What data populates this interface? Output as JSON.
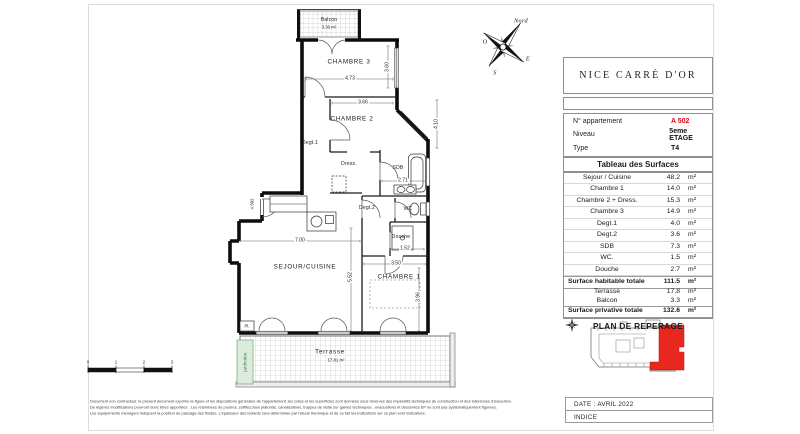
{
  "project": {
    "title": "NICE CARRÉ D'OR"
  },
  "apartment": {
    "rows": [
      {
        "label": "N° appartement",
        "value": "A 502"
      },
      {
        "label": "Niveau",
        "value": "5eme ETAGE"
      },
      {
        "label": "Type",
        "value": "T4"
      }
    ]
  },
  "surfaces": {
    "title": "Tableau des Surfaces",
    "unit": "m²",
    "rows": [
      {
        "label": "Sejour / Cuisine",
        "value": "48.2"
      },
      {
        "label": "Chambre 1",
        "value": "14.0"
      },
      {
        "label": "Chambre 2 + Dress.",
        "value": "15.3"
      },
      {
        "label": "Chambre 3",
        "value": "14.9"
      },
      {
        "label": "Degt.1",
        "value": "4.0"
      },
      {
        "label": "Degt.2",
        "value": "3.6"
      },
      {
        "label": "SDB",
        "value": "7.3"
      },
      {
        "label": "WC.",
        "value": "1.5"
      },
      {
        "label": "Douche",
        "value": "2.7"
      }
    ],
    "habitable": {
      "label": "Surface habitable totale",
      "value": "111.5"
    },
    "annexes": [
      {
        "label": "Terrasse",
        "value": "17.8"
      },
      {
        "label": "Balcon",
        "value": "3.3"
      }
    ],
    "privative": {
      "label": "Surface privative totale",
      "value": "132.6"
    }
  },
  "reperage": {
    "title": "PLAN DE REPERAGE"
  },
  "footer_box": {
    "date": "DATE : AVRIL 2022",
    "indice": "INDICE"
  },
  "disclaimer": {
    "line1": "Document non contractuel: le present document exprime la figure et les dispositions générales de l'appartement ,les cotes et les superficies sont données sous réserves des impératifs techniques de construction et des tolérances d'éxecution.",
    "line2": "De légères modifications pourront donc êtres apportées . Les retombées de poutres ,soffites,faux plafonds, canalisations, trappes de visite sur gaines techniques , évacuations et descentes EP ne sont pas systématiquement figurées.",
    "line3": "Les équipements ménagers indiquent la position de passage des fluides. L'épaisseur des isolants sera déterminée par l'étude thermique et de ce fait les indications sur ce plan sont indicatives."
  },
  "compass": {
    "north": "Nord",
    "west": "O",
    "east": "E",
    "south": "S"
  },
  "scalebar": {
    "t0": "0",
    "t1": "1",
    "t2": "2",
    "t3": "3"
  },
  "plan": {
    "balcon": {
      "name": "Balcon",
      "area": "3.30 m²"
    },
    "terrasse": {
      "name": "Terrasse",
      "area": "17.81 m²"
    },
    "chambre3": "CHAMBRE 3",
    "chambre2": "CHAMBRE 2",
    "chambre1": "CHAMBRE 1",
    "sejour": "SEJOUR/CUISINE",
    "degt1": "Degt.1",
    "degt2": "Degt.2",
    "dress": "Dress.",
    "sdb": "SDB",
    "wc": "WC",
    "douche": "Douche",
    "jardiniere": "jardinière",
    "entry": "A 502",
    "placard": "Pl.",
    "dims": {
      "chambre3_w": "4.73",
      "chambre3_h": "3.60",
      "chambre2_w": "3.66",
      "chambre2_h": "4.10",
      "sdb_w": "2.71",
      "douche_w": "1.52",
      "chambre1_w": "3.50",
      "chambre1_h": "3.96",
      "sejour_w": "7.00",
      "sejour_h": "5.52"
    }
  },
  "colors": {
    "accent_red": "#e30613",
    "site_unit_red": "#e8281e",
    "jardiniere_green": "#dcecdc"
  }
}
